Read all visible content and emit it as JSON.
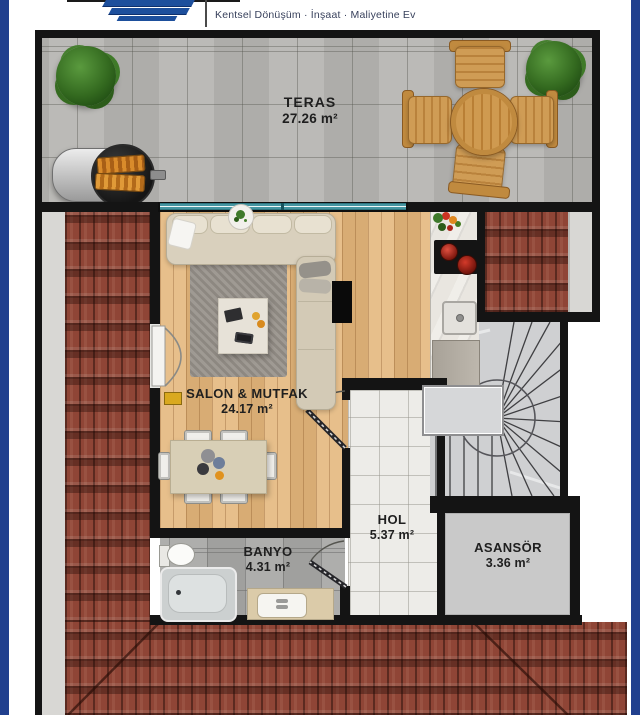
{
  "header": {
    "tagline": "Kentsel Dönüşüm · İnşaat · Maliyetine Ev",
    "logo": "blue-bars-logo"
  },
  "rooms": {
    "teras": {
      "name": "TERAS",
      "area": "27.26 m²"
    },
    "salon": {
      "name": "SALON & MUTFAK",
      "area": "24.17 m²"
    },
    "hol": {
      "name": "HOL",
      "area": "5.37 m²"
    },
    "asansor": {
      "name": "ASANSÖR",
      "area": "3.36 m²"
    },
    "banyo": {
      "name": "BANYO",
      "area": "4.31 m²"
    }
  },
  "colors": {
    "frame_navy": "#21408e",
    "wall_black": "#141414",
    "roof_red": "#8f4536",
    "wood_floor": "#e4b87e",
    "terrace_gray": "#b7b6b3",
    "window_teal": "#4596a2",
    "logo_blue": "#1d4f9c"
  }
}
